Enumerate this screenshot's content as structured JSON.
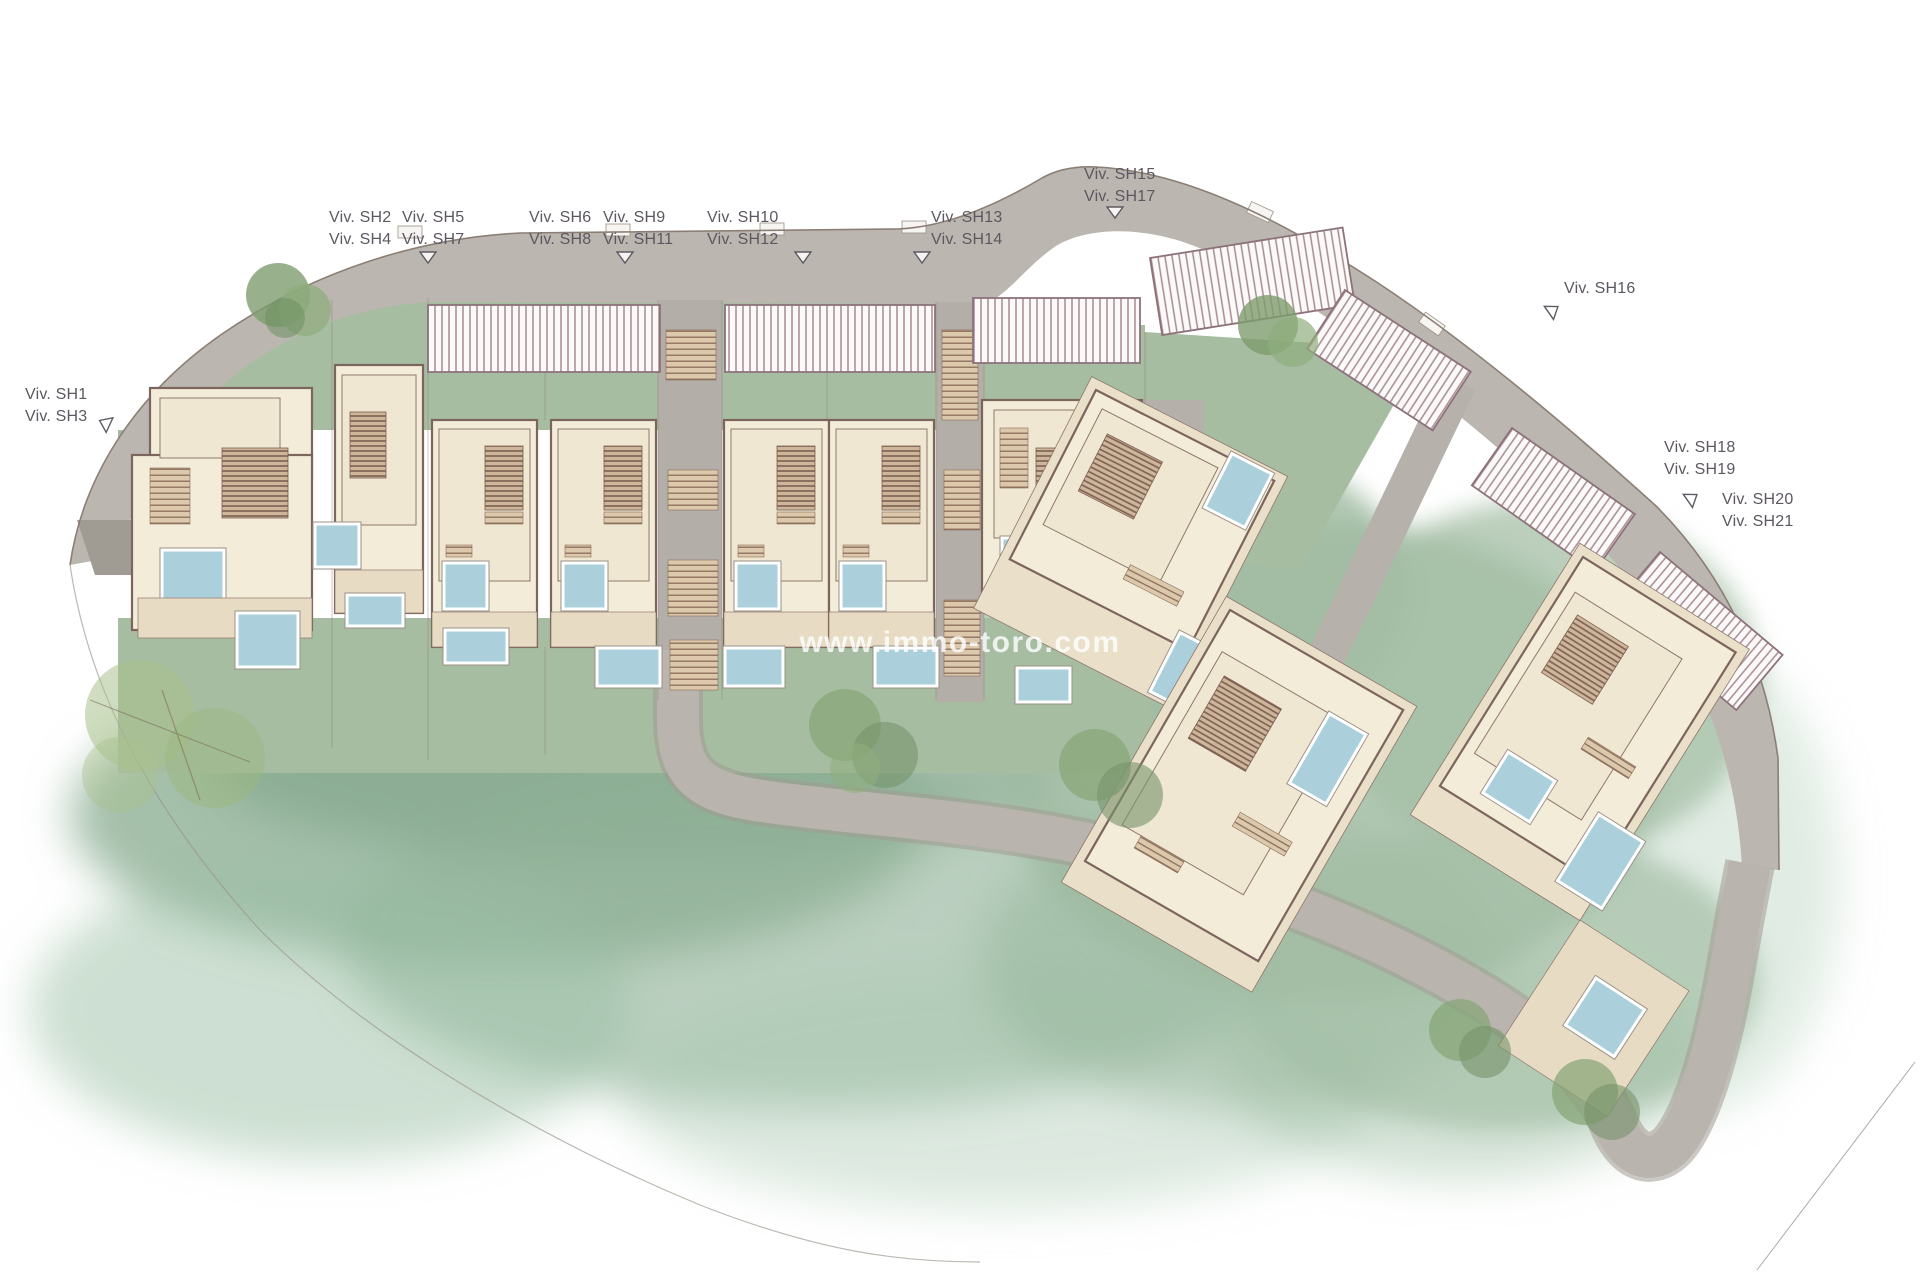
{
  "watermark": {
    "text": "www.immo-toro.com"
  },
  "plan": {
    "unit_labels": [
      {
        "id": "viv-sh1-sh3",
        "lines": [
          "Viv. SH1",
          "Viv. SH3"
        ]
      },
      {
        "id": "viv-sh2-sh4",
        "lines": [
          "Viv. SH2",
          "Viv. SH4"
        ]
      },
      {
        "id": "viv-sh5-sh7",
        "lines": [
          "Viv. SH5",
          "Viv. SH7"
        ]
      },
      {
        "id": "viv-sh6-sh8",
        "lines": [
          "Viv. SH6",
          "Viv. SH8"
        ]
      },
      {
        "id": "viv-sh9-sh11",
        "lines": [
          "Viv. SH9",
          "Viv. SH11"
        ]
      },
      {
        "id": "viv-sh10-sh12",
        "lines": [
          "Viv. SH10",
          "Viv. SH12"
        ]
      },
      {
        "id": "viv-sh13-sh14",
        "lines": [
          "Viv. SH13",
          "Viv. SH14"
        ]
      },
      {
        "id": "viv-sh15-sh17",
        "lines": [
          "Viv. SH15",
          "Viv. SH17"
        ]
      },
      {
        "id": "viv-sh16",
        "lines": [
          "Viv. SH16"
        ]
      },
      {
        "id": "viv-sh18-sh19",
        "lines": [
          "Viv. SH18",
          "Viv. SH19"
        ]
      },
      {
        "id": "viv-sh20-sh21",
        "lines": [
          "Viv. SH20",
          "Viv. SH21"
        ]
      }
    ],
    "colors": {
      "road": "#bbb7b0",
      "lawn": "#a7bda2",
      "watercolor_wash": "#8aab90",
      "building": "#f3ecd8",
      "building_outline": "#7c655c",
      "deck": "#e7dbc3",
      "pool": "#abd0dc",
      "pool_border": "#ffffff",
      "pergola_stripe": "#a58a92",
      "tree": "#8aa87b",
      "label_text": "#5d5761",
      "watermark_text": "#ffffff"
    }
  }
}
